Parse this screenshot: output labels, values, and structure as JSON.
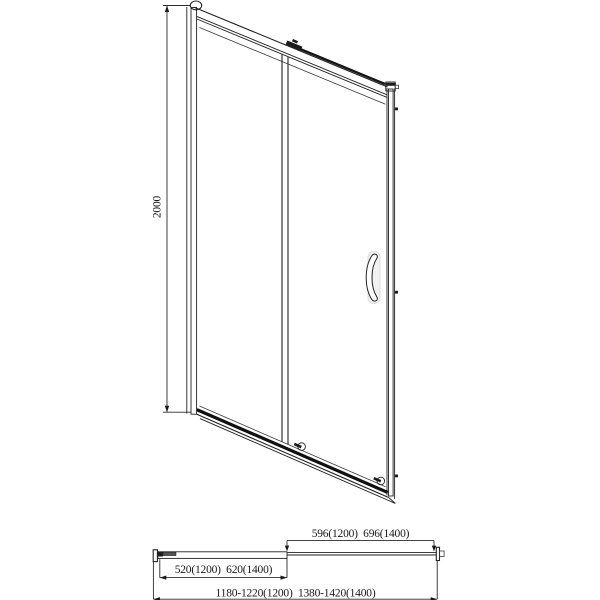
{
  "front_view": {
    "height_dim": "2000"
  },
  "top_view": {
    "panel_width_dim": "596(1200)  696(1400)",
    "slide_width_dim": "520(1200)  620(1400)",
    "overall_width_dim": "1180-1220(1200)  1380-1420(1400)"
  },
  "colors": {
    "line": "#222222",
    "profile_fill": "#c4c4c4",
    "bar_fill": "#ababab",
    "dark_detail": "#1f1f1f"
  }
}
